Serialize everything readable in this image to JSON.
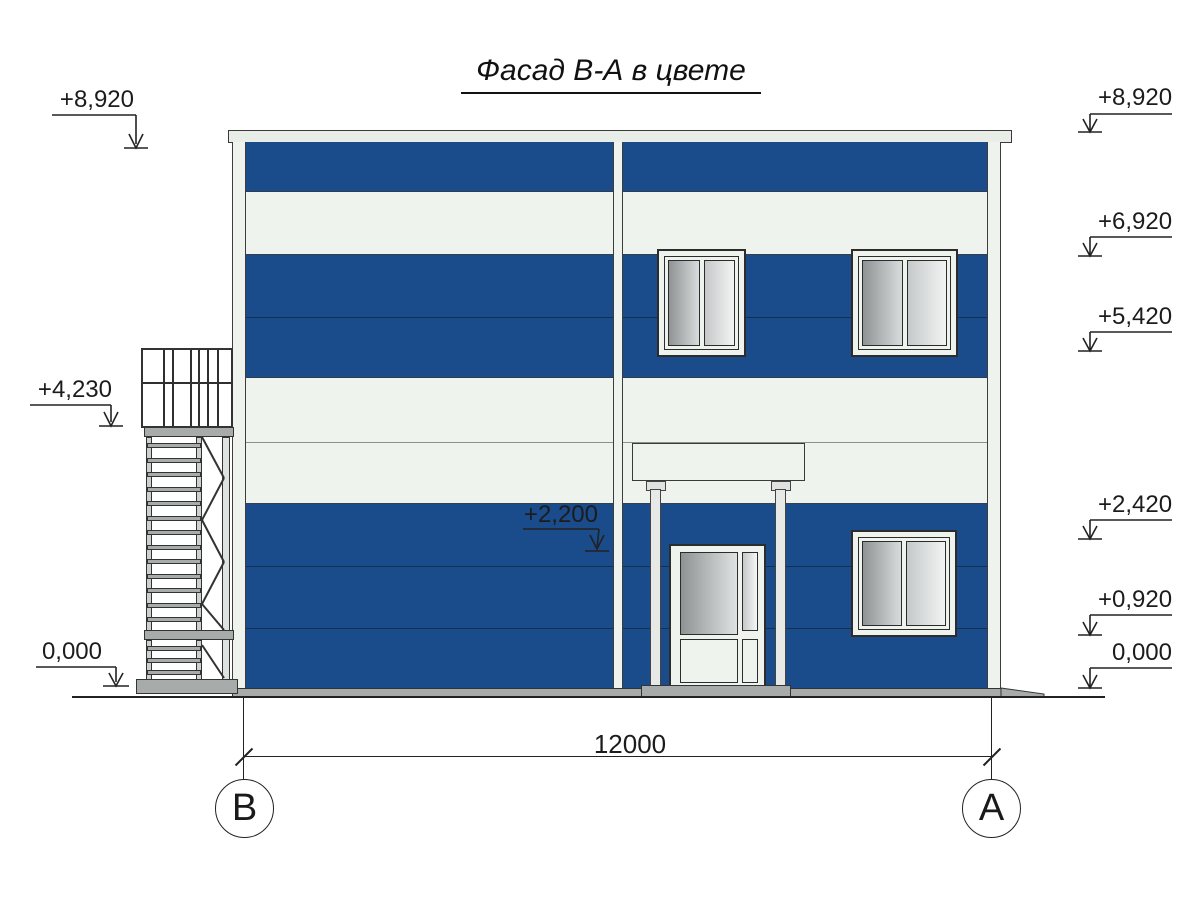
{
  "title": "Фасад В-А в цвете",
  "elevation_markers": {
    "left": [
      "+8,920",
      "+4,230",
      "0,000"
    ],
    "right": [
      "+8,920",
      "+6,920",
      "+5,420",
      "+2,420",
      "+0,920",
      "0,000"
    ],
    "door_lintel": "+2,200"
  },
  "dimension": {
    "width_label": "12000"
  },
  "axes": {
    "left": "В",
    "right": "А"
  },
  "colors": {
    "facade_blue": "#1a4b8b",
    "panel_white": "#eff3ed",
    "coping_white": "#e9ede7",
    "concrete_gray": "#a7acaa",
    "glass_dark": "#8f9394",
    "glass_light": "#f2f4f4"
  }
}
